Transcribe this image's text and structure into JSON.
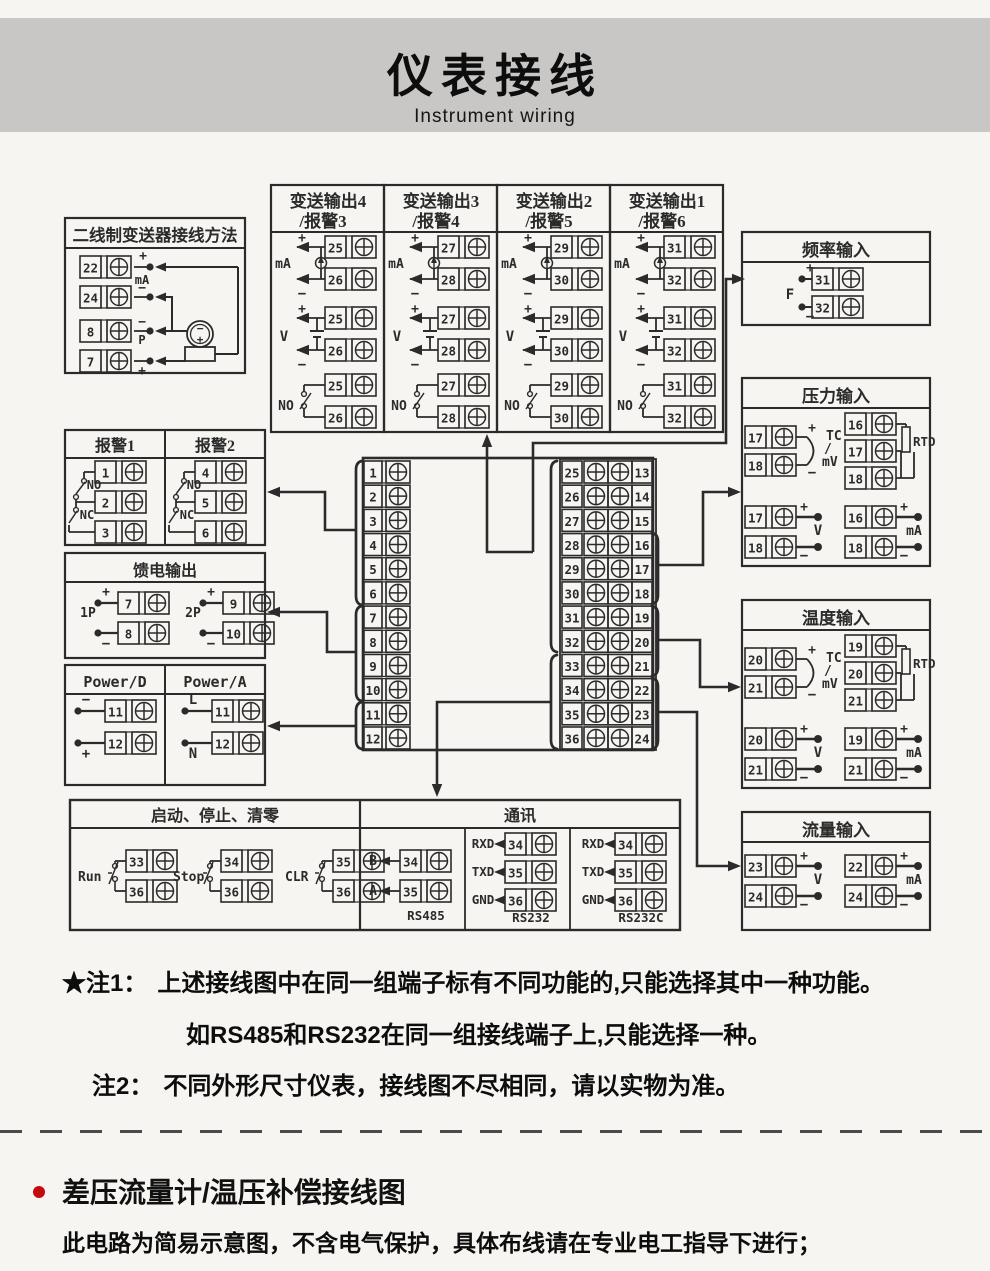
{
  "page": {
    "bg": "#f6f5f2",
    "line_color": "#2b2b2b",
    "accent_red": "#c40a0a"
  },
  "header": {
    "title": "仪表接线",
    "subtitle": "Instrument wiring",
    "band_color": "#c9c7c6"
  },
  "diagram": {
    "signs": {
      "plus": "+",
      "minus": "−"
    },
    "two_wire": {
      "title": "二线制变送器接线方法",
      "rows": [
        {
          "n": "22",
          "sign": "+",
          "label": "mA"
        },
        {
          "n": "24",
          "sign": "−",
          "label": ""
        },
        {
          "n": "8",
          "sign": "−",
          "label": ""
        },
        {
          "n": "7",
          "sign": "+",
          "label": "P"
        }
      ],
      "transmitter": {
        "top": "−",
        "bottom": "+"
      }
    },
    "outputs": [
      {
        "title1": "变送输出4",
        "title2": "/报警3",
        "top": "25",
        "bot": "26"
      },
      {
        "title1": "变送输出3",
        "title2": "/报警4",
        "top": "27",
        "bot": "28"
      },
      {
        "title1": "变送输出2",
        "title2": "/报警5",
        "top": "29",
        "bot": "30"
      },
      {
        "title1": "变送输出1",
        "title2": "/报警6",
        "top": "31",
        "bot": "32"
      }
    ],
    "output_sections": {
      "ma": "mA",
      "v": "V",
      "no": "NO"
    },
    "freq": {
      "title": "频率输入",
      "label": "F",
      "top": "31",
      "bot": "32"
    },
    "pressure": {
      "title": "压力输入",
      "tcmv": {
        "labels": [
          "TC",
          "/",
          "mV"
        ],
        "t": [
          "17",
          "18"
        ]
      },
      "rtd": {
        "label": "RTD",
        "t": [
          "16",
          "17",
          "18"
        ]
      },
      "v": {
        "label": "V",
        "t": [
          "17",
          "18"
        ]
      },
      "ma": {
        "label": "mA",
        "t": [
          "16",
          "18"
        ]
      }
    },
    "temperature": {
      "title": "温度输入",
      "tcmv": {
        "labels": [
          "TC",
          "/",
          "mV"
        ],
        "t": [
          "20",
          "21"
        ]
      },
      "rtd": {
        "label": "RTD",
        "t": [
          "19",
          "20",
          "21"
        ]
      },
      "v": {
        "label": "V",
        "t": [
          "20",
          "21"
        ]
      },
      "ma": {
        "label": "mA",
        "t": [
          "19",
          "21"
        ]
      }
    },
    "flow": {
      "title": "流量输入",
      "v": {
        "label": "V",
        "t": [
          "23",
          "24"
        ]
      },
      "ma": {
        "label": "mA",
        "t": [
          "22",
          "24"
        ]
      }
    },
    "alarms": {
      "halves": [
        {
          "title": "报警1",
          "no": "NO",
          "nc": "NC",
          "t": [
            "1",
            "2",
            "3"
          ]
        },
        {
          "title": "报警2",
          "no": "NO",
          "nc": "NC",
          "t": [
            "4",
            "5",
            "6"
          ]
        }
      ]
    },
    "feed": {
      "title": "馈电输出",
      "groups": [
        {
          "label": "1P",
          "top": "7",
          "bot": "8"
        },
        {
          "label": "2P",
          "top": "9",
          "bot": "10"
        }
      ]
    },
    "power": {
      "halves": [
        {
          "title": "Power/D",
          "rows": [
            {
              "label": "−",
              "n": "11"
            },
            {
              "label": "+",
              "n": "12"
            }
          ]
        },
        {
          "title": "Power/A",
          "rows": [
            {
              "label": "L",
              "n": "11"
            },
            {
              "label": "N",
              "n": "12"
            }
          ]
        }
      ]
    },
    "runstop": {
      "title": "启动、停止、清零",
      "groups": [
        {
          "label": "Run",
          "top": "33",
          "bot": "36"
        },
        {
          "label": "Stop",
          "top": "34",
          "bot": "36"
        },
        {
          "label": "CLR",
          "top": "35",
          "bot": "36"
        }
      ]
    },
    "comm": {
      "title": "通讯",
      "groups": [
        {
          "name": "RS485",
          "rows": [
            {
              "label": "B",
              "n": "34"
            },
            {
              "label": "A",
              "n": "35"
            }
          ]
        },
        {
          "name": "RS232",
          "rows": [
            {
              "label": "RXD",
              "n": "34"
            },
            {
              "label": "TXD",
              "n": "35"
            },
            {
              "label": "GND",
              "n": "36"
            }
          ]
        },
        {
          "name": "RS232C",
          "rows": [
            {
              "label": "RXD",
              "n": "34"
            },
            {
              "label": "TXD",
              "n": "35"
            },
            {
              "label": "GND",
              "n": "36"
            }
          ]
        }
      ]
    },
    "center": {
      "left": [
        "1",
        "2",
        "3",
        "4",
        "5",
        "6",
        "7",
        "8",
        "9",
        "10",
        "11",
        "12"
      ],
      "mid": [
        "25",
        "26",
        "27",
        "28",
        "29",
        "30",
        "31",
        "32",
        "33",
        "34",
        "35",
        "36"
      ],
      "right": [
        "13",
        "14",
        "15",
        "16",
        "17",
        "18",
        "19",
        "20",
        "21",
        "22",
        "23",
        "24"
      ]
    }
  },
  "notes": {
    "note1_tag": "★注1：",
    "note1_line1": "上述接线图中在同一组端子标有不同功能的,只能选择其中一种功能。",
    "note1_line2": "如RS485和RS232在同一组接线端子上,只能选择一种。",
    "note2_tag": "注2：",
    "note2_text": "不同外形尺寸仪表，接线图不尽相同，请以实物为准。"
  },
  "footer": {
    "section_title": "差压流量计/温压补偿接线图",
    "description": "此电路为简易示意图，不含电气保护，具体布线请在专业电工指导下进行；"
  }
}
